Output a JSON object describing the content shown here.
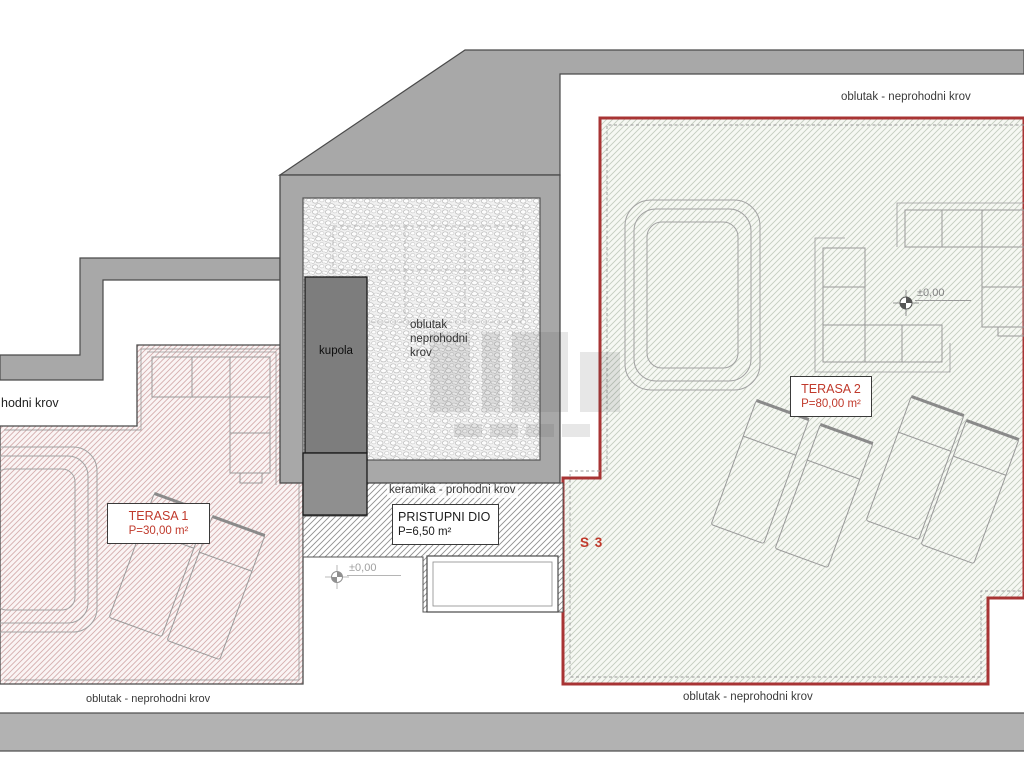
{
  "plan": {
    "terraces": {
      "terasa1": {
        "title": "TERASA 1",
        "area": "P=30,00 m²"
      },
      "terasa2": {
        "title": "TERASA 2",
        "area": "P=80,00 m²"
      },
      "pristupni": {
        "title": "PRISTUPNI DIO",
        "area": "P=6,50 m²"
      },
      "unit_label": "S 3"
    },
    "annotations": {
      "roof_top": "oblutak - neprohodni krov",
      "roof_bottom_left": "oblutak - neprohodni krov",
      "roof_bottom_right": "oblutak - neprohodni krov",
      "roof_left_fragment": "hodni krov",
      "walkable_strip": "keramika - prohodni krov",
      "center_roof_line1": "oblutak",
      "center_roof_line2": "neprohodni",
      "center_roof_line3": "krov",
      "kupola": "kupola",
      "elevation_terrace2": "±0,00",
      "elevation_access": "±0,00"
    },
    "colors": {
      "wall_fill": "#a8a8a8",
      "wall_outline": "#4a4a4a",
      "terrace_boundary_red": "#a83434",
      "label_red": "#c0392b",
      "hatch_pink": "#d5aeae",
      "hatch_green": "#c3ccc0",
      "hatch_gray": "#8f8f8f"
    }
  }
}
